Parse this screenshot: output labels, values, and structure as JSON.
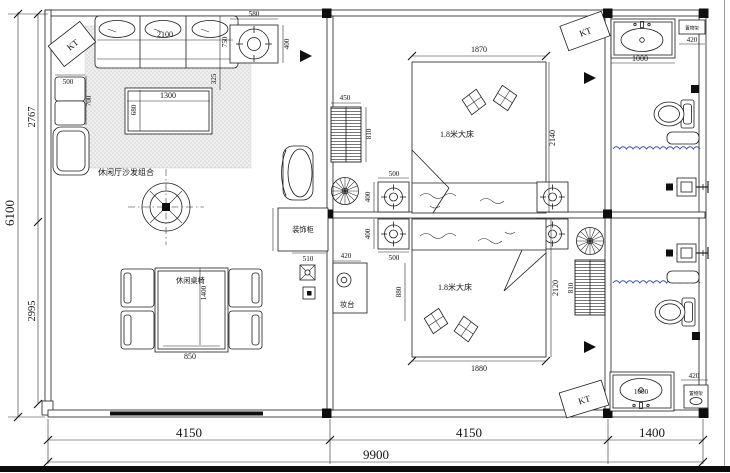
{
  "colors": {
    "line": "#1c1c1c",
    "water_line": "#3d56a8",
    "background": "#ffffff"
  },
  "labels": {
    "sofa_zone": "休闲厅沙发组合",
    "dining": "休闲桌椅",
    "bed1": "1.8米大床",
    "bed2": "1.8米大床",
    "cabinet": "装饰柜",
    "dresser": "妆台",
    "shelf1": "置物架",
    "shelf2": "置物架",
    "kt1": "KT",
    "kt2": "KT",
    "kt3": "KT"
  },
  "dims": {
    "bottom_left_bay": "4150",
    "bottom_mid_bay": "4150",
    "bottom_right_bay": "1400",
    "bottom_total": "9900",
    "left_total": "6100",
    "left_upper": "2767",
    "left_lower": "2995",
    "light_w": "580",
    "light_h": "400",
    "sofa_w": "2100",
    "sofa_d": "750",
    "sofa_gap": "325",
    "side_w": "500",
    "side_d": "700",
    "coffee_l": "1300",
    "coffee_w": "680",
    "table_w": "850",
    "table_l": "1400",
    "cabinet_w": "510",
    "ns_top_w": "500",
    "ns_top_d": "400",
    "ns_bot_d": "400",
    "ns_bot_w": "500",
    "bed1_w": "1870",
    "bed1_l": "2140",
    "bed2_w": "1880",
    "bed2_l": "2120",
    "ward1_w": "450",
    "ward1_d": "810",
    "ward2_d": "810",
    "dresser_w": "420",
    "dresser_l": "880",
    "vanity1_w": "1000",
    "shelf1_w": "420",
    "vanity2_w": "1000",
    "shelf2_w": "420"
  }
}
